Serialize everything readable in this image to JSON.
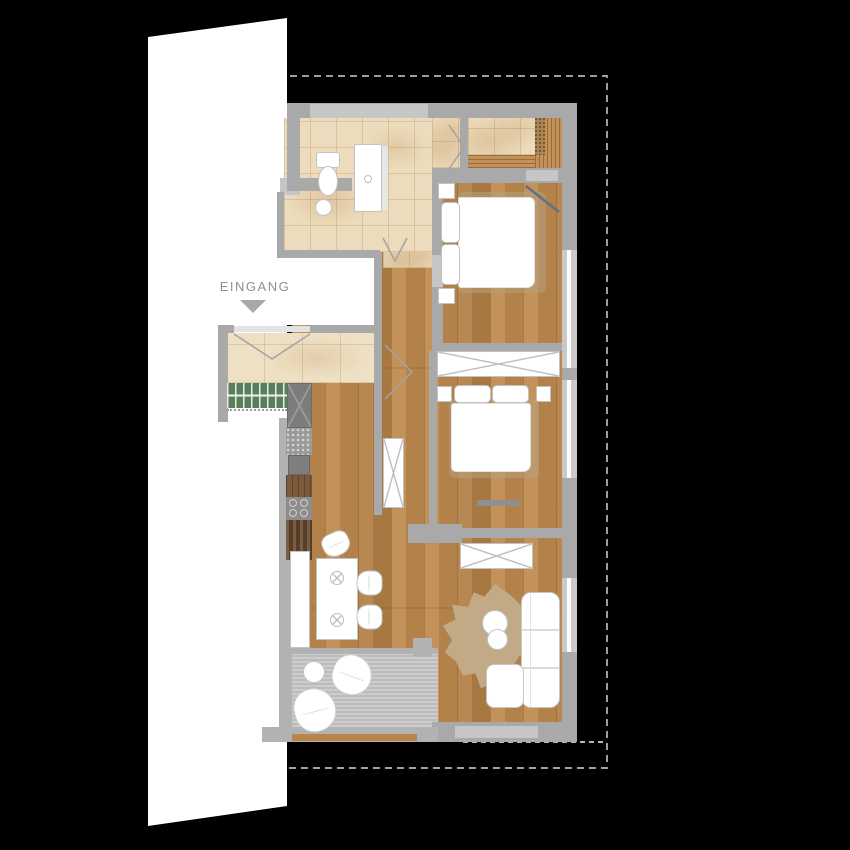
{
  "document": {
    "type": "apartment-floor-plan",
    "entrance_label": "EINGANG"
  },
  "rooms": {
    "list": [
      "entrance-hall",
      "bathroom",
      "walk-in-closet",
      "hallway",
      "bedroom-1",
      "bedroom-2",
      "kitchen",
      "dining-area",
      "living-room",
      "balcony"
    ]
  },
  "furniture": {
    "list": [
      "toilet",
      "vanity",
      "washbasin",
      "coat-rack",
      "tall-cabinet",
      "kitchen-counter",
      "kitchen-sink",
      "cooktop",
      "sideboard",
      "dining-table",
      "dining-chairs",
      "double-bed-1",
      "double-bed-2",
      "nightstands",
      "wardrobes",
      "sofa",
      "coffee-tables",
      "rug",
      "balcony-table",
      "lounge-chairs"
    ]
  },
  "colors": {
    "background": "#000000",
    "adjacent_building": "#ffffff",
    "wall": "#a9a9a9",
    "wall_light": "#c6c6c6",
    "window_glass": "#ffffff",
    "tile_floor": "#ecdcbd",
    "wood_floor": "#be8a4e",
    "deck": "#c7c7c7",
    "rug": "#c2aa87",
    "coat_rack_green": "#5a7f5b",
    "kitchen_dark": "#7c7c7c",
    "boundary_dash": "#9e9e9e",
    "door_swing": "#a3a3a3",
    "door_swing_accent": "#5e7189",
    "furniture": "#ffffff"
  }
}
